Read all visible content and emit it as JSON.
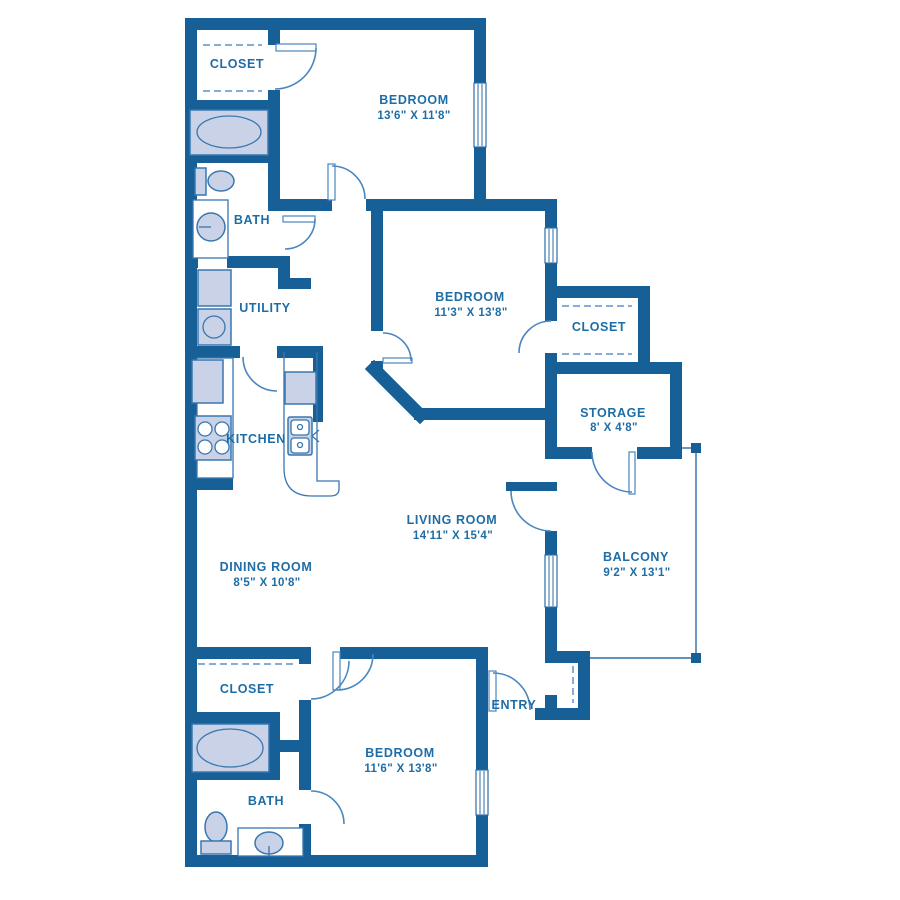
{
  "colors": {
    "wall": "#165f97",
    "text": "#1e6da6",
    "door": "#4a86c0",
    "fixture_fill": "#c9d2e6",
    "fixture_stroke": "#3977b0",
    "dash": "#85add8",
    "thin": "#2d6da8"
  },
  "rooms": {
    "closet_top": {
      "name": "CLOSET"
    },
    "bedroom_top": {
      "name": "BEDROOM",
      "dims": "13'6\" X 11'8\""
    },
    "bath_top": {
      "name": "BATH"
    },
    "bedroom_middle": {
      "name": "BEDROOM",
      "dims": "11'3\" X 13'8\""
    },
    "closet_right": {
      "name": "CLOSET"
    },
    "utility": {
      "name": "UTILITY"
    },
    "storage": {
      "name": "STORAGE",
      "dims": "8' X 4'8\""
    },
    "kitchen": {
      "name": "KITCHEN"
    },
    "living": {
      "name": "LIVING ROOM",
      "dims": "14'11\" X 15'4\""
    },
    "dining": {
      "name": "DINING ROOM",
      "dims": "8'5\" X 10'8\""
    },
    "balcony": {
      "name": "BALCONY",
      "dims": "9'2\" X 13'1\""
    },
    "closet_bottom": {
      "name": "CLOSET"
    },
    "entry": {
      "name": "ENTRY"
    },
    "bedroom_bottom": {
      "name": "BEDROOM",
      "dims": "11'6\" X 13'8\""
    },
    "bath_bottom": {
      "name": "BATH"
    }
  }
}
